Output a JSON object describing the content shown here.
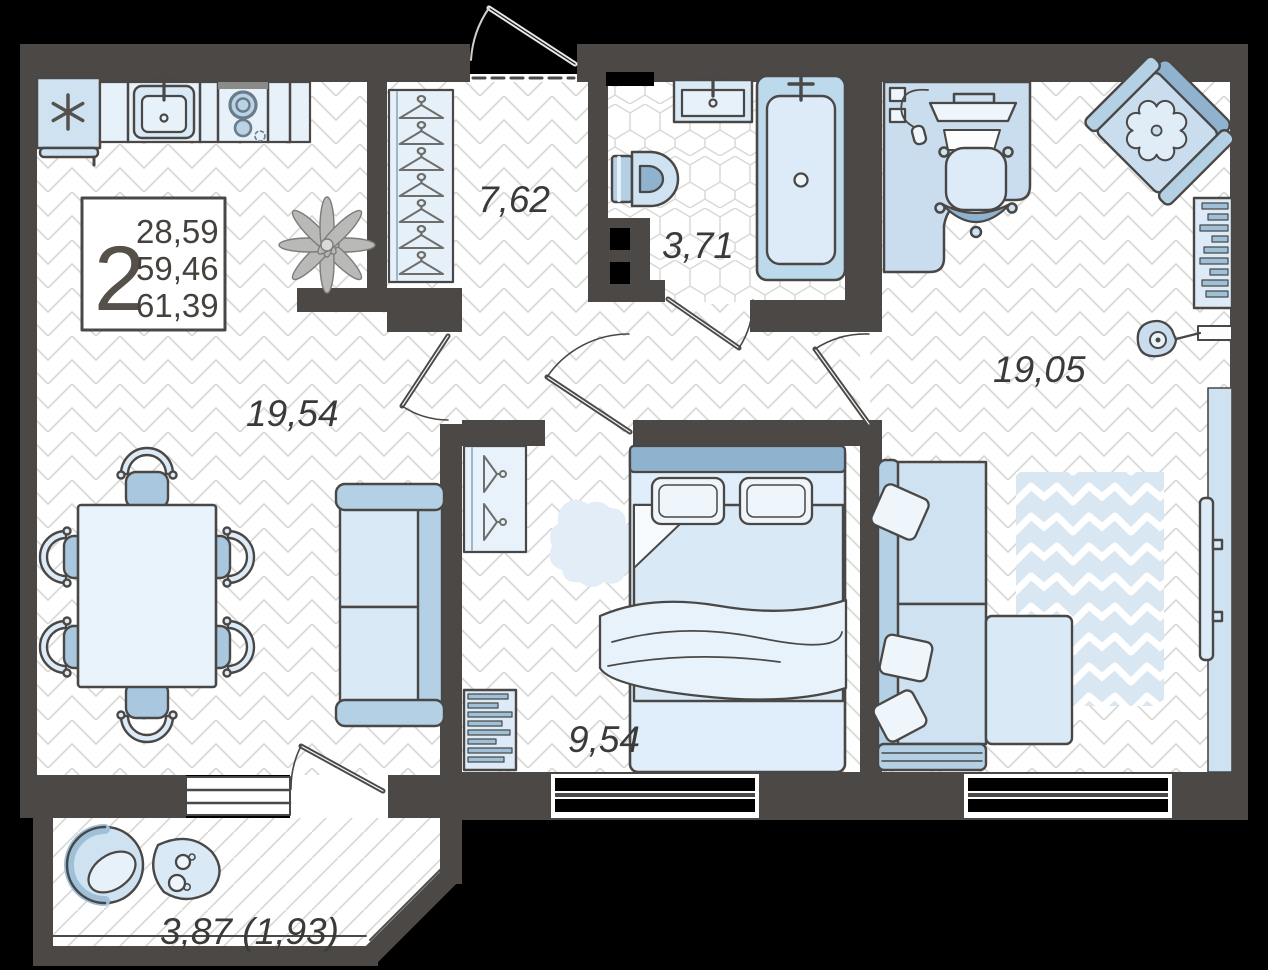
{
  "plan": {
    "legend": {
      "room_count": "2",
      "area_living": "28,59",
      "area_total": "59,46",
      "area_total_coeff": "61,39"
    },
    "labels": {
      "living_kitchen": "19,54",
      "hallway": "7,62",
      "bathroom": "3,71",
      "bedroom": "9,54",
      "room": "19,05",
      "balcony": "3,87 (1,93)"
    },
    "colors": {
      "background": "#000000",
      "wall": "#4b4846",
      "floor": "#ffffff",
      "floor_line": "#d7d7d5",
      "furniture_light": "#cfe2f1",
      "furniture_pale": "#e7f1fa",
      "furniture_accent": "#9fc0d9",
      "outline": "#4a4846",
      "label_text": "#3a3a38",
      "rug_chevron": "#d9e7f3"
    }
  }
}
